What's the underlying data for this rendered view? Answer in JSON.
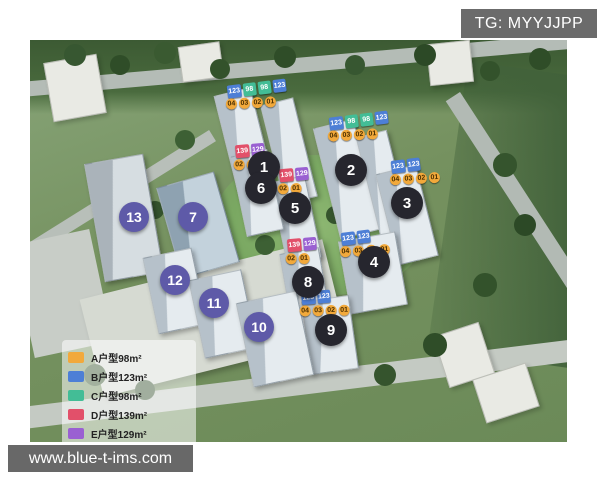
{
  "header": {
    "tg_label": "TG: MYYJJPP"
  },
  "watermark": {
    "url_text": "www.blue-t-ims.com"
  },
  "legend": {
    "items": [
      {
        "code": "A",
        "label": "A户型98m²",
        "color": "#f2a93b"
      },
      {
        "code": "B",
        "label": "B户型123m²",
        "color": "#4d7fd6"
      },
      {
        "code": "C",
        "label": "C户型98m²",
        "color": "#43bd96"
      },
      {
        "code": "D",
        "label": "D户型139m²",
        "color": "#e2506a"
      },
      {
        "code": "E",
        "label": "E户型129m²",
        "color": "#9a60d2"
      }
    ]
  },
  "map": {
    "building_markers": [
      {
        "number": "1",
        "type": "dark",
        "x": 234,
        "y": 127
      },
      {
        "number": "2",
        "type": "dark",
        "x": 321,
        "y": 130
      },
      {
        "number": "3",
        "type": "dark",
        "x": 377,
        "y": 163
      },
      {
        "number": "4",
        "type": "dark",
        "x": 344,
        "y": 222
      },
      {
        "number": "5",
        "type": "dark",
        "x": 265,
        "y": 168
      },
      {
        "number": "6",
        "type": "dark",
        "x": 231,
        "y": 148
      },
      {
        "number": "7",
        "type": "purple",
        "x": 163,
        "y": 177
      },
      {
        "number": "8",
        "type": "dark",
        "x": 278,
        "y": 242
      },
      {
        "number": "9",
        "type": "dark",
        "x": 301,
        "y": 290
      },
      {
        "number": "10",
        "type": "purple",
        "x": 229,
        "y": 287
      },
      {
        "number": "11",
        "type": "purple",
        "x": 184,
        "y": 263
      },
      {
        "number": "12",
        "type": "purple",
        "x": 145,
        "y": 240
      },
      {
        "number": "13",
        "type": "purple",
        "x": 104,
        "y": 177
      }
    ],
    "roofs": {
      "b1": {
        "tags": [
          {
            "t": "123",
            "type": "B"
          },
          {
            "t": "98",
            "type": "C"
          },
          {
            "t": "98",
            "type": "C"
          },
          {
            "t": "123",
            "type": "B"
          }
        ],
        "nums": [
          {
            "t": "04"
          },
          {
            "t": "03"
          },
          {
            "t": "02"
          },
          {
            "t": "01"
          }
        ]
      },
      "b2": {
        "tags": [
          {
            "t": "123",
            "type": "B"
          },
          {
            "t": "98",
            "type": "C"
          },
          {
            "t": "98",
            "type": "C"
          },
          {
            "t": "123",
            "type": "B"
          }
        ],
        "nums": [
          {
            "t": "04"
          },
          {
            "t": "03"
          },
          {
            "t": "02"
          },
          {
            "t": "01"
          }
        ]
      },
      "b3": {
        "tags": [
          {
            "t": "123",
            "type": "B"
          },
          {
            "t": "123",
            "type": "B"
          }
        ],
        "nums": [
          {
            "t": "04"
          },
          {
            "t": "03"
          },
          {
            "t": "02"
          },
          {
            "t": "01"
          }
        ]
      },
      "b4": {
        "tags": [
          {
            "t": "123",
            "type": "B"
          },
          {
            "t": "123",
            "type": "B"
          }
        ],
        "nums": [
          {
            "t": "04"
          },
          {
            "t": "03"
          },
          {
            "t": "02"
          },
          {
            "t": "01"
          }
        ]
      },
      "b5": {
        "tags": [
          {
            "t": "139",
            "type": "D"
          },
          {
            "t": "129",
            "type": "E"
          }
        ],
        "nums": [
          {
            "t": "02"
          },
          {
            "t": "01"
          }
        ]
      },
      "b6": {
        "tags": [
          {
            "t": "139",
            "type": "D"
          },
          {
            "t": "129",
            "type": "E"
          }
        ],
        "nums": [
          {
            "t": "02"
          },
          {
            "t": "01"
          }
        ]
      },
      "b8": {
        "tags": [
          {
            "t": "139",
            "type": "D"
          },
          {
            "t": "129",
            "type": "E"
          }
        ],
        "nums": [
          {
            "t": "02"
          },
          {
            "t": "01"
          }
        ]
      },
      "b9": {
        "tags": [
          {
            "t": "123",
            "type": "B"
          },
          {
            "t": "123",
            "type": "B"
          }
        ],
        "nums": [
          {
            "t": "04"
          },
          {
            "t": "03"
          },
          {
            "t": "02"
          },
          {
            "t": "01"
          }
        ]
      }
    }
  }
}
